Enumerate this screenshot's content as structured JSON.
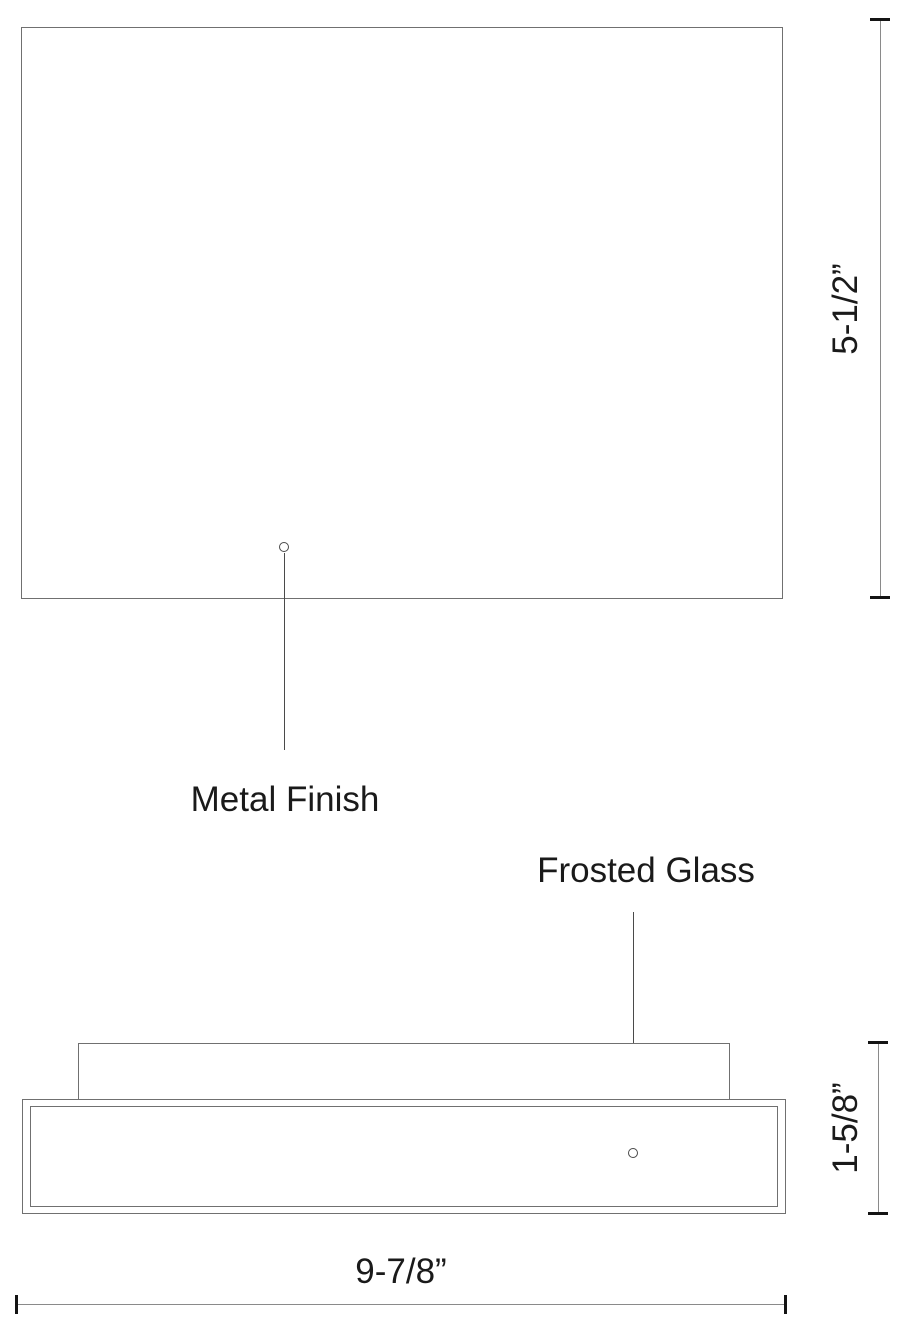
{
  "drawing": {
    "title": "flush-mount fixture dimension drawing",
    "views": [
      "front",
      "side"
    ]
  },
  "labels": {
    "metal_finish": "Metal Finish",
    "frosted_glass": "Frosted Glass"
  },
  "dimensions": {
    "front_height": "5-1/2”",
    "side_height": "1-5/8”",
    "width": "9-7/8”"
  },
  "colors": {
    "line": "#707070",
    "leader": "#4a4a4a",
    "tick": "#141414",
    "text": "#1a1a1a",
    "bg": "#ffffff"
  }
}
